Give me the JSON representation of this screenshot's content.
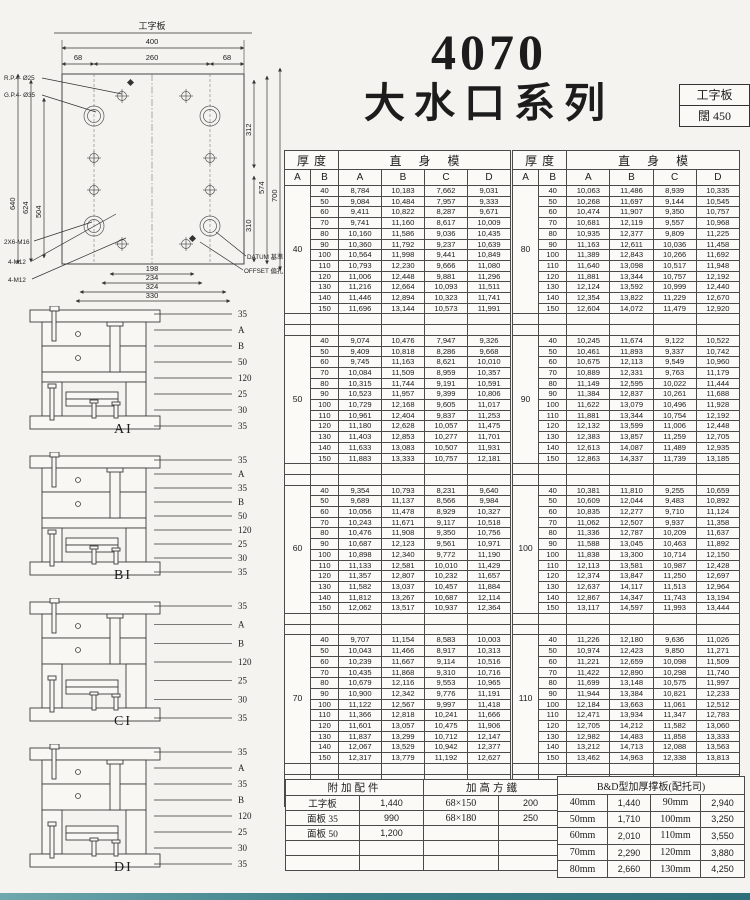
{
  "title": {
    "model": "4070",
    "series": "大水口系列"
  },
  "spec_box": {
    "type": "工字板",
    "width_label": "闊",
    "width_value": "450"
  },
  "drawing": {
    "top_label": "工字板",
    "w400": "400",
    "w260": "260",
    "w68l": "68",
    "w68r": "68",
    "h640": "640",
    "h624": "624",
    "h504": "504",
    "h312": "312",
    "h310": "310",
    "h574": "574",
    "h700": "700",
    "b198": "198",
    "b234": "234",
    "b324": "324",
    "b330": "330",
    "rp": "R.P.4- Ø25",
    "gp": "G.P.4- Ø35",
    "m16": "2X6-M16",
    "m12a": "4-M12",
    "m12b": "4-M12",
    "datum": "DATUM 基準",
    "offset": "OFFSET 偏孔"
  },
  "diagrams": [
    {
      "label": "AI",
      "callouts": [
        "35",
        "A",
        "B",
        "50",
        "120",
        "25",
        "30",
        "35"
      ]
    },
    {
      "label": "BI",
      "callouts": [
        "35",
        "A",
        "35",
        "B",
        "50",
        "120",
        "25",
        "30",
        "35"
      ]
    },
    {
      "label": "CI",
      "callouts": [
        "35",
        "A",
        "B",
        "120",
        "25",
        "30",
        "35"
      ]
    },
    {
      "label": "DI",
      "callouts": [
        "35",
        "A",
        "35",
        "B",
        "120",
        "25",
        "30",
        "35"
      ]
    }
  ],
  "main_tables": {
    "header": {
      "thickness": "厚度",
      "straight_mold": "直身模",
      "sub_a": "A",
      "sub_b": "B",
      "value_cols": [
        "A",
        "B",
        "C",
        "D"
      ]
    },
    "left": [
      {
        "A": "40",
        "rows": [
          [
            "40",
            "8,784",
            "10,183",
            "7,662",
            "9,031"
          ],
          [
            "50",
            "9,084",
            "10,484",
            "7,957",
            "9,333"
          ],
          [
            "60",
            "9,411",
            "10,822",
            "8,287",
            "9,671"
          ],
          [
            "70",
            "9,741",
            "11,160",
            "8,617",
            "10,009"
          ],
          [
            "80",
            "10,160",
            "11,586",
            "9,036",
            "10,435"
          ],
          [
            "90",
            "10,360",
            "11,792",
            "9,237",
            "10,639"
          ],
          [
            "100",
            "10,564",
            "11,998",
            "9,441",
            "10,849"
          ],
          [
            "110",
            "10,793",
            "12,230",
            "9,666",
            "11,080"
          ],
          [
            "120",
            "11,006",
            "12,448",
            "9,881",
            "11,296"
          ],
          [
            "130",
            "11,216",
            "12,664",
            "10,093",
            "11,511"
          ],
          [
            "140",
            "11,446",
            "12,894",
            "10,323",
            "11,741"
          ],
          [
            "150",
            "11,696",
            "13,144",
            "10,573",
            "11,991"
          ]
        ]
      },
      {
        "A": "50",
        "rows": [
          [
            "40",
            "9,074",
            "10,476",
            "7,947",
            "9,326"
          ],
          [
            "50",
            "9,409",
            "10,818",
            "8,286",
            "9,668"
          ],
          [
            "60",
            "9,745",
            "11,163",
            "8,621",
            "10,010"
          ],
          [
            "70",
            "10,084",
            "11,509",
            "8,959",
            "10,357"
          ],
          [
            "80",
            "10,315",
            "11,744",
            "9,191",
            "10,591"
          ],
          [
            "90",
            "10,523",
            "11,957",
            "9,399",
            "10,806"
          ],
          [
            "100",
            "10,729",
            "12,168",
            "9,605",
            "11,017"
          ],
          [
            "110",
            "10,961",
            "12,404",
            "9,837",
            "11,253"
          ],
          [
            "120",
            "11,180",
            "12,628",
            "10,057",
            "11,475"
          ],
          [
            "130",
            "11,403",
            "12,853",
            "10,277",
            "11,701"
          ],
          [
            "140",
            "11,633",
            "13,083",
            "10,507",
            "11,931"
          ],
          [
            "150",
            "11,883",
            "13,333",
            "10,757",
            "12,181"
          ]
        ]
      },
      {
        "A": "60",
        "rows": [
          [
            "40",
            "9,354",
            "10,793",
            "8,231",
            "9,640"
          ],
          [
            "50",
            "9,689",
            "11,137",
            "8,566",
            "9,984"
          ],
          [
            "60",
            "10,056",
            "11,478",
            "8,929",
            "10,327"
          ],
          [
            "70",
            "10,243",
            "11,671",
            "9,117",
            "10,518"
          ],
          [
            "80",
            "10,476",
            "11,908",
            "9,350",
            "10,756"
          ],
          [
            "90",
            "10,687",
            "12,123",
            "9,561",
            "10,971"
          ],
          [
            "100",
            "10,898",
            "12,340",
            "9,772",
            "11,190"
          ],
          [
            "110",
            "11,133",
            "12,581",
            "10,010",
            "11,429"
          ],
          [
            "120",
            "11,357",
            "12,807",
            "10,232",
            "11,657"
          ],
          [
            "130",
            "11,582",
            "13,037",
            "10,457",
            "11,884"
          ],
          [
            "140",
            "11,812",
            "13,267",
            "10,687",
            "12,114"
          ],
          [
            "150",
            "12,062",
            "13,517",
            "10,937",
            "12,364"
          ]
        ]
      },
      {
        "A": "70",
        "rows": [
          [
            "40",
            "9,707",
            "11,154",
            "8,583",
            "10,003"
          ],
          [
            "50",
            "10,043",
            "11,466",
            "8,917",
            "10,313"
          ],
          [
            "60",
            "10,239",
            "11,667",
            "9,114",
            "10,516"
          ],
          [
            "70",
            "10,435",
            "11,868",
            "9,310",
            "10,716"
          ],
          [
            "80",
            "10,679",
            "12,116",
            "9,553",
            "10,965"
          ],
          [
            "90",
            "10,900",
            "12,342",
            "9,776",
            "11,191"
          ],
          [
            "100",
            "11,122",
            "12,567",
            "9,997",
            "11,418"
          ],
          [
            "110",
            "11,366",
            "12,818",
            "10,241",
            "11,666"
          ],
          [
            "120",
            "11,601",
            "13,057",
            "10,475",
            "11,906"
          ],
          [
            "130",
            "11,837",
            "13,299",
            "10,712",
            "12,147"
          ],
          [
            "140",
            "12,067",
            "13,529",
            "10,942",
            "12,377"
          ],
          [
            "150",
            "12,317",
            "13,779",
            "11,192",
            "12,627"
          ]
        ]
      }
    ],
    "right": [
      {
        "A": "80",
        "rows": [
          [
            "40",
            "10,063",
            "11,486",
            "8,939",
            "10,335"
          ],
          [
            "50",
            "10,268",
            "11,697",
            "9,144",
            "10,545"
          ],
          [
            "60",
            "10,474",
            "11,907",
            "9,350",
            "10,757"
          ],
          [
            "70",
            "10,681",
            "12,119",
            "9,557",
            "10,968"
          ],
          [
            "80",
            "10,935",
            "12,377",
            "9,809",
            "11,225"
          ],
          [
            "90",
            "11,163",
            "12,611",
            "10,036",
            "11,458"
          ],
          [
            "100",
            "11,389",
            "12,843",
            "10,266",
            "11,692"
          ],
          [
            "110",
            "11,640",
            "13,098",
            "10,517",
            "11,948"
          ],
          [
            "120",
            "11,881",
            "13,344",
            "10,757",
            "12,192"
          ],
          [
            "130",
            "12,124",
            "13,592",
            "10,999",
            "12,440"
          ],
          [
            "140",
            "12,354",
            "13,822",
            "11,229",
            "12,670"
          ],
          [
            "150",
            "12,604",
            "14,072",
            "11,479",
            "12,920"
          ]
        ]
      },
      {
        "A": "90",
        "rows": [
          [
            "40",
            "10,245",
            "11,674",
            "9,122",
            "10,522"
          ],
          [
            "50",
            "10,461",
            "11,893",
            "9,337",
            "10,742"
          ],
          [
            "60",
            "10,675",
            "12,113",
            "9,549",
            "10,960"
          ],
          [
            "70",
            "10,889",
            "12,331",
            "9,763",
            "11,179"
          ],
          [
            "80",
            "11,149",
            "12,595",
            "10,022",
            "11,444"
          ],
          [
            "90",
            "11,384",
            "12,837",
            "10,261",
            "11,688"
          ],
          [
            "100",
            "11,622",
            "13,079",
            "10,496",
            "11,928"
          ],
          [
            "110",
            "11,881",
            "13,344",
            "10,754",
            "12,192"
          ],
          [
            "120",
            "12,132",
            "13,599",
            "11,006",
            "12,448"
          ],
          [
            "130",
            "12,383",
            "13,857",
            "11,259",
            "12,705"
          ],
          [
            "140",
            "12,613",
            "14,087",
            "11,489",
            "12,935"
          ],
          [
            "150",
            "12,863",
            "14,337",
            "11,739",
            "13,185"
          ]
        ]
      },
      {
        "A": "100",
        "rows": [
          [
            "40",
            "10,381",
            "11,810",
            "9,255",
            "10,659"
          ],
          [
            "50",
            "10,609",
            "12,044",
            "9,483",
            "10,892"
          ],
          [
            "60",
            "10,835",
            "12,277",
            "9,710",
            "11,124"
          ],
          [
            "70",
            "11,062",
            "12,507",
            "9,937",
            "11,358"
          ],
          [
            "80",
            "11,336",
            "12,787",
            "10,209",
            "11,637"
          ],
          [
            "90",
            "11,588",
            "13,045",
            "10,463",
            "11,892"
          ],
          [
            "100",
            "11,838",
            "13,300",
            "10,714",
            "12,150"
          ],
          [
            "110",
            "12,113",
            "13,581",
            "10,987",
            "12,428"
          ],
          [
            "120",
            "12,374",
            "13,847",
            "11,250",
            "12,697"
          ],
          [
            "130",
            "12,637",
            "14,117",
            "11,513",
            "12,964"
          ],
          [
            "140",
            "12,867",
            "14,347",
            "11,743",
            "13,194"
          ],
          [
            "150",
            "13,117",
            "14,597",
            "11,993",
            "13,444"
          ]
        ]
      },
      {
        "A": "110",
        "rows": [
          [
            "40",
            "11,226",
            "12,180",
            "9,636",
            "11,026"
          ],
          [
            "50",
            "10,974",
            "12,423",
            "9,850",
            "11,271"
          ],
          [
            "60",
            "11,221",
            "12,659",
            "10,098",
            "11,509"
          ],
          [
            "70",
            "11,422",
            "12,890",
            "10,298",
            "11,740"
          ],
          [
            "80",
            "11,699",
            "13,148",
            "10,575",
            "11,997"
          ],
          [
            "90",
            "11,944",
            "13,384",
            "10,821",
            "12,233"
          ],
          [
            "100",
            "12,184",
            "13,663",
            "11,061",
            "12,512"
          ],
          [
            "110",
            "12,471",
            "13,934",
            "11,347",
            "12,783"
          ],
          [
            "120",
            "12,705",
            "14,212",
            "11,582",
            "13,060"
          ],
          [
            "130",
            "12,982",
            "14,483",
            "11,858",
            "13,333"
          ],
          [
            "140",
            "13,212",
            "14,713",
            "12,088",
            "13,563"
          ],
          [
            "150",
            "13,462",
            "14,963",
            "12,338",
            "13,813"
          ]
        ]
      }
    ]
  },
  "accessories_table": {
    "header_left": "附加配件",
    "header_right": "加高方鐵",
    "rows": [
      [
        "工字板",
        "1,440",
        "68×150",
        "200"
      ],
      [
        "面板 35",
        "990",
        "68×180",
        "250"
      ],
      [
        "面板 50",
        "1,200",
        "",
        ""
      ],
      [
        "",
        "",
        "",
        ""
      ],
      [
        "",
        "",
        "",
        ""
      ]
    ]
  },
  "bd_table": {
    "title": "B&D型加厚撑板(配托司)",
    "rows": [
      [
        "40mm",
        "1,440",
        "90mm",
        "2,940"
      ],
      [
        "50mm",
        "1,710",
        "100mm",
        "3,250"
      ],
      [
        "60mm",
        "2,010",
        "110mm",
        "3,550"
      ],
      [
        "70mm",
        "2,290",
        "120mm",
        "3,880"
      ],
      [
        "80mm",
        "2,660",
        "130mm",
        "4,250"
      ]
    ]
  }
}
